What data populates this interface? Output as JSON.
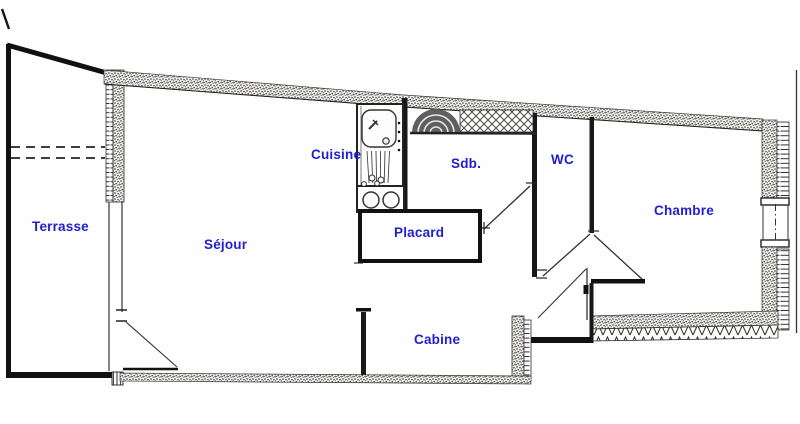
{
  "plan": {
    "rooms": [
      {
        "id": "terrasse",
        "label": "Terrasse"
      },
      {
        "id": "sejour",
        "label": "Séjour"
      },
      {
        "id": "cuisine",
        "label": "Cuisine"
      },
      {
        "id": "sdb",
        "label": "Sdb."
      },
      {
        "id": "wc",
        "label": "WC"
      },
      {
        "id": "placard",
        "label": "Placard"
      },
      {
        "id": "cabine",
        "label": "Cabine"
      },
      {
        "id": "chambre",
        "label": "Chambre"
      }
    ],
    "colors": {
      "label": "#2121cc",
      "wall": "#1a1a1a",
      "background": "#fefefe"
    },
    "fixtures": [
      "kitchen-sink-icon",
      "cooktop-icon",
      "bathtub-icon",
      "crosshatch-closet",
      "window-icon",
      "door-swing-icon"
    ]
  }
}
